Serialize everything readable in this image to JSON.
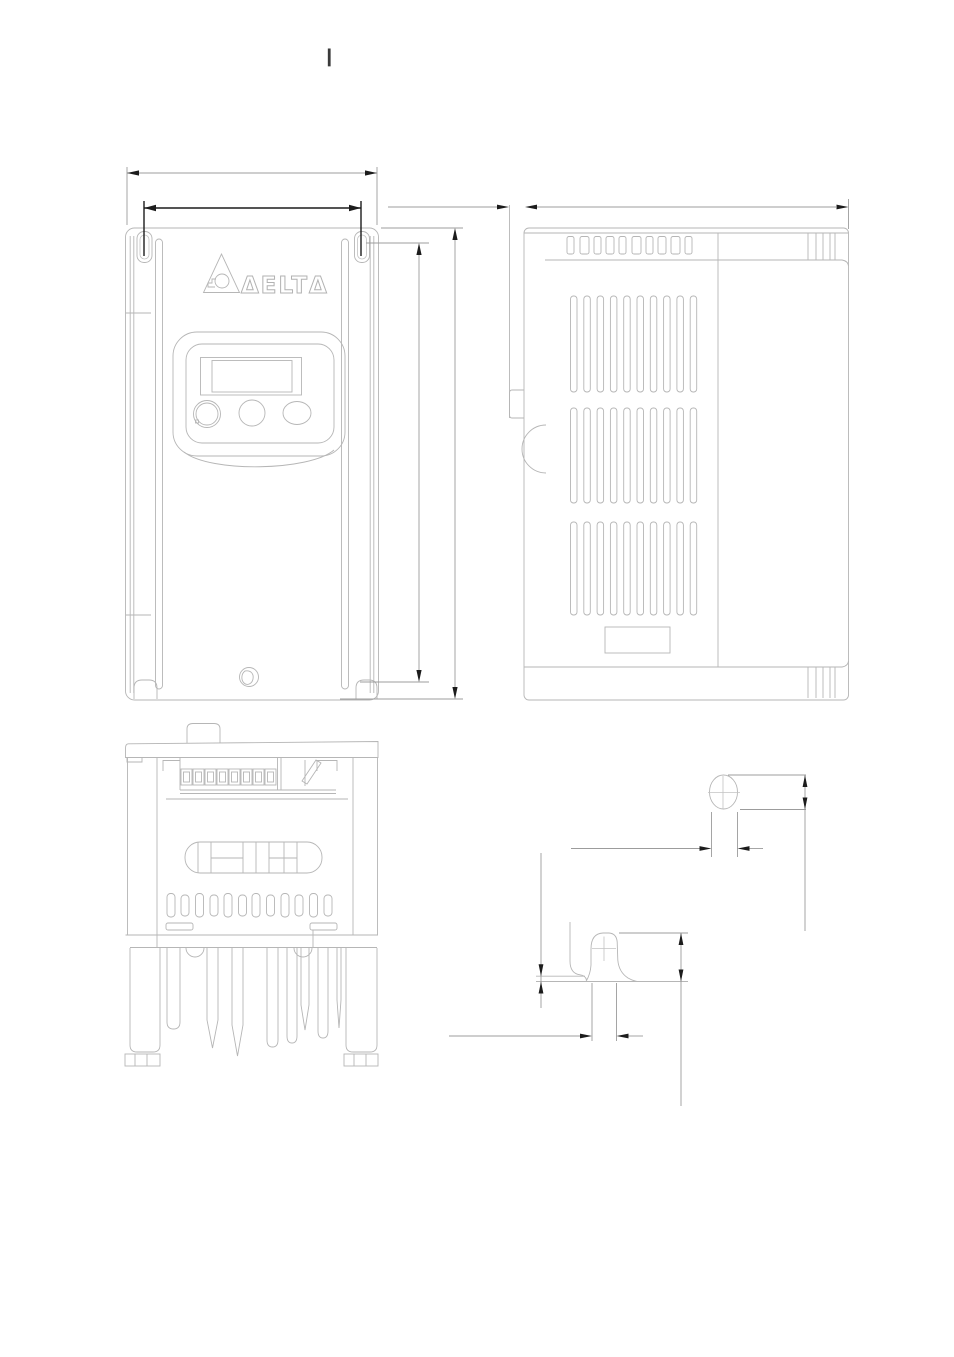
{
  "header": {
    "mark": "|"
  },
  "logo": {
    "brand": "DELTA",
    "text": "ΔELTΔ"
  },
  "colors": {
    "background": "#ffffff",
    "outline": "#b6b6b6",
    "dimension_line": "#9c9c9c",
    "dimension_strong": "#1c1c1c",
    "arrow_fill": "#1c1c1c",
    "header_mark": "#3a3a3a"
  },
  "drawing": {
    "kind": "mechanical dimension drawing",
    "views": [
      "front view",
      "side view",
      "bottom view",
      "mounting hole detail",
      "keyhole slot detail"
    ]
  }
}
